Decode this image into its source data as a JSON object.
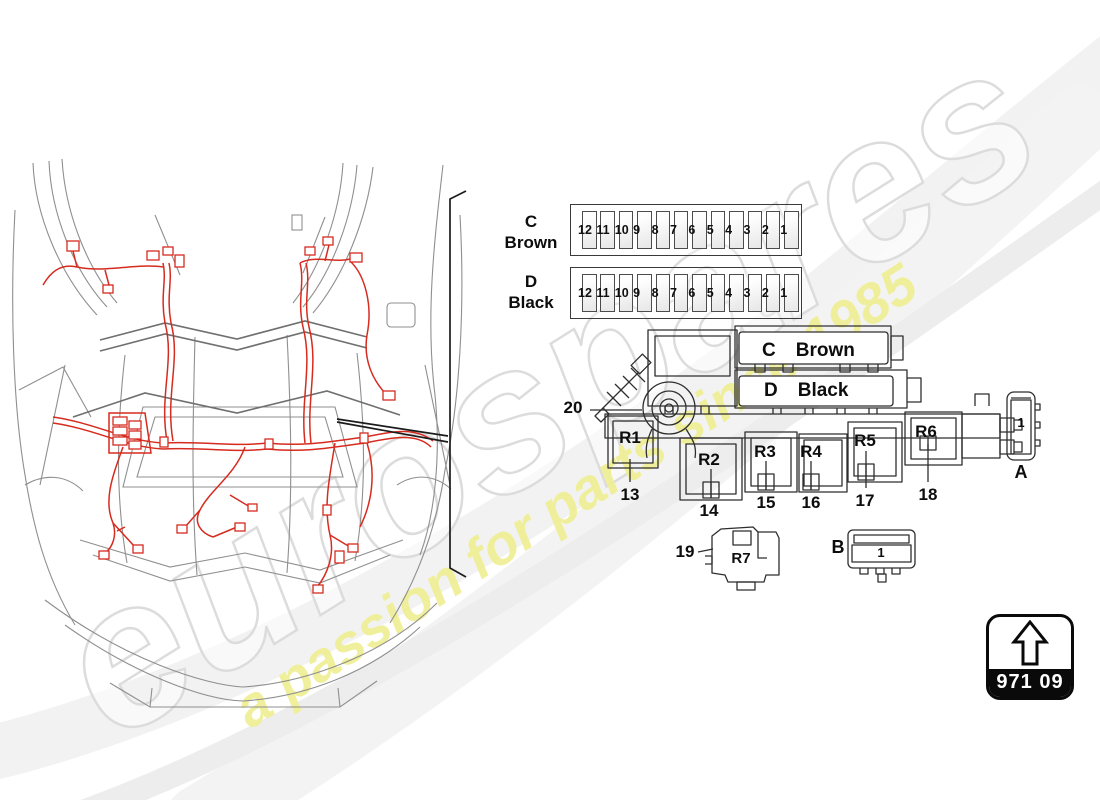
{
  "watermark": {
    "brand": "eurospares",
    "tagline": "a passion for parts since 1985",
    "brand_outline_color": "#dcdcdc",
    "tagline_color": "#efef97"
  },
  "colors": {
    "harness_red": "#d62b1f",
    "car_line_gray": "#8f8f8f",
    "diagram_line": "#2e2e2e"
  },
  "fuse_strips": [
    {
      "label_letter": "C",
      "label_color": "Brown",
      "fuses": [
        "12",
        "11",
        "10",
        "9",
        "8",
        "7",
        "6",
        "5",
        "4",
        "3",
        "2",
        "1"
      ]
    },
    {
      "label_letter": "D",
      "label_color": "Black",
      "fuses": [
        "12",
        "11",
        "10",
        "9",
        "8",
        "7",
        "6",
        "5",
        "4",
        "3",
        "2",
        "1"
      ]
    }
  ],
  "fusebox": {
    "slots": [
      {
        "letter": "C",
        "name": "Brown"
      },
      {
        "letter": "D",
        "name": "Black"
      }
    ],
    "relays": [
      {
        "label": "R1",
        "callout": "13"
      },
      {
        "label": "R2",
        "callout": "14"
      },
      {
        "label": "R3",
        "callout": "15"
      },
      {
        "label": "R4",
        "callout": "16"
      },
      {
        "label": "R5",
        "callout": "17"
      },
      {
        "label": "R6",
        "callout": "18"
      }
    ],
    "callout_box": "20",
    "relay_7": {
      "callout": "19",
      "label": "R7"
    },
    "connector_a": {
      "cavity": "1",
      "label": "A"
    },
    "connector_b": {
      "cavity": "1",
      "label": "B"
    }
  },
  "part_tag": {
    "code": "971 09"
  }
}
